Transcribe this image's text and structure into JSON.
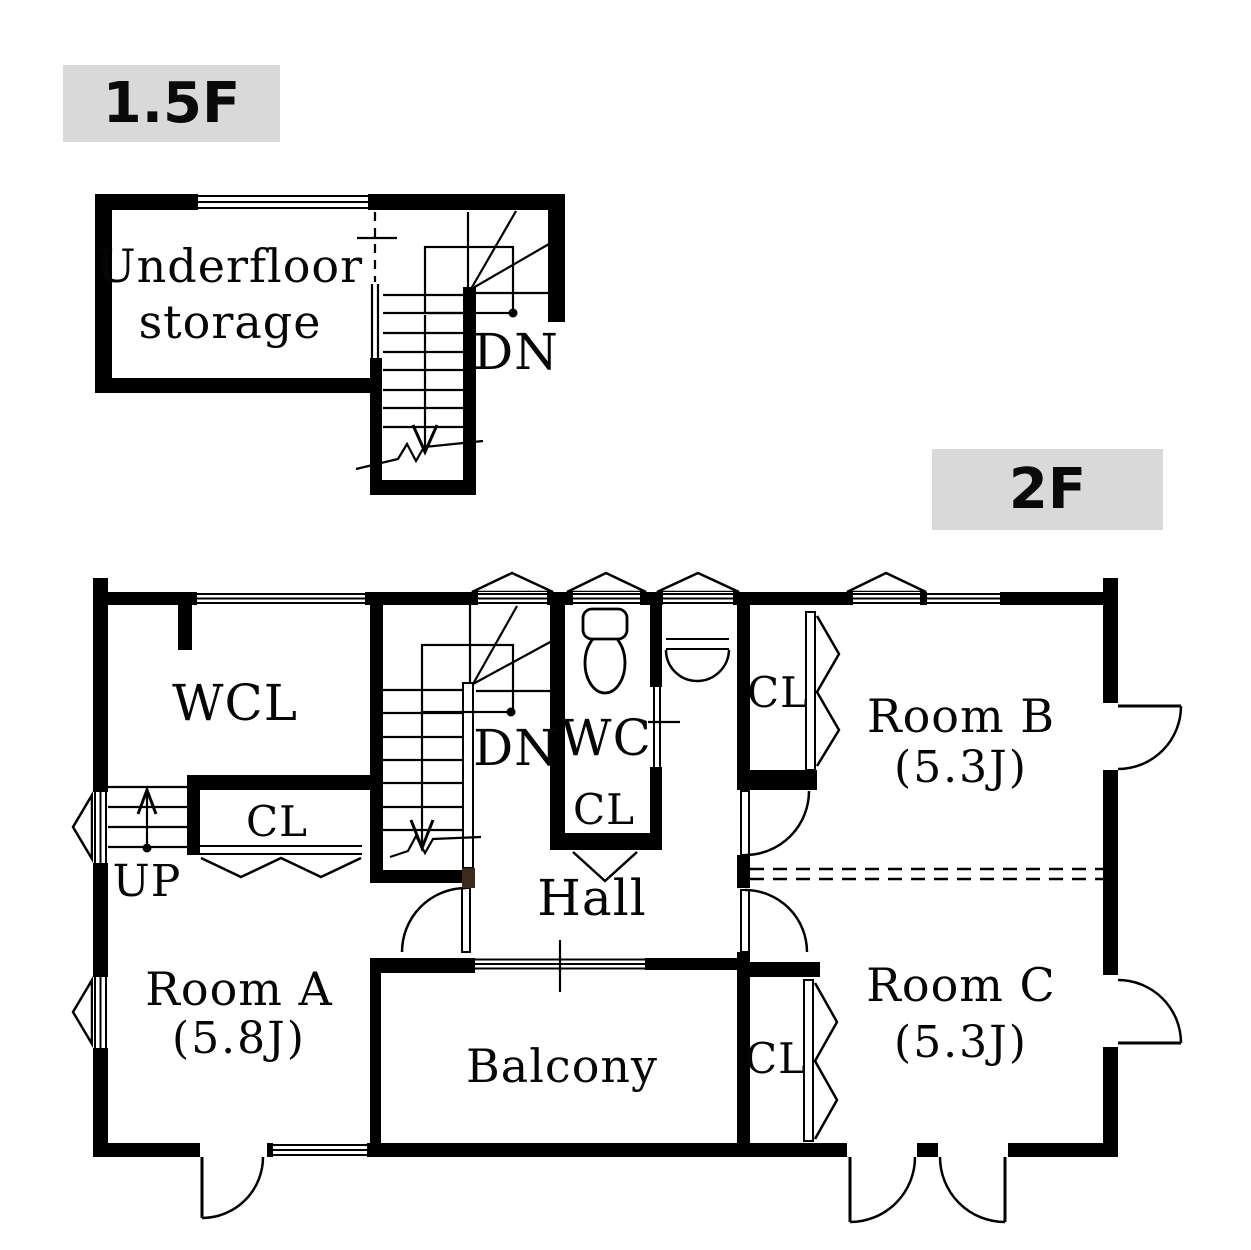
{
  "colors": {
    "line": "#000000",
    "floor_label_bg": "#d9d9d9",
    "newel_post": "#3a2b1e",
    "background": "#ffffff"
  },
  "floors": {
    "f15": {
      "label": "1.5F",
      "underfloor_line1": "Underfloor",
      "underfloor_line2": "storage",
      "dn": "DN"
    },
    "f2": {
      "label": "2F",
      "wcl": "WCL",
      "cl_left": "CL",
      "up": "UP",
      "dn": "DN",
      "wc": "WC",
      "cl_wc": "CL",
      "cl_room_b": "CL",
      "room_b_name": "Room B",
      "room_b_size": "(5.3J)",
      "hall": "Hall",
      "room_a_name": "Room A",
      "room_a_size": "(5.8J)",
      "balcony": "Balcony",
      "cl_room_c": "CL",
      "room_c_name": "Room C",
      "room_c_size": "(5.3J)"
    }
  }
}
